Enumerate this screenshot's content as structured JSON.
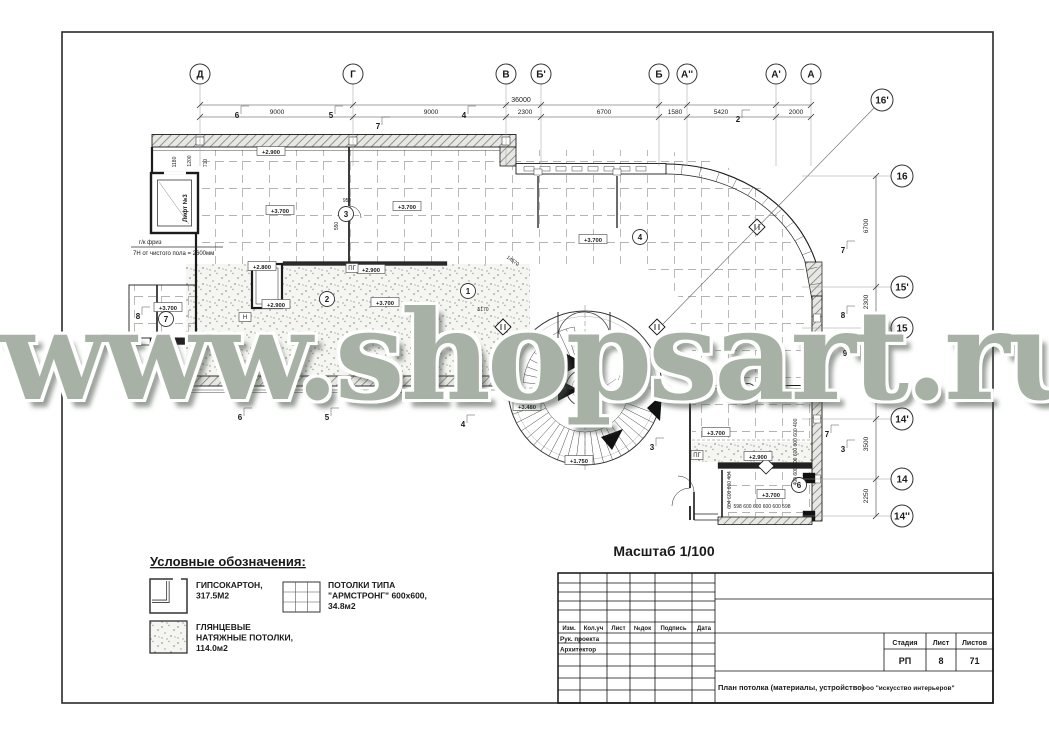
{
  "watermark": "www.shopsart.ru",
  "scale_label": "Масштаб 1/100",
  "legend": {
    "title": "Условные обозначения:",
    "items": [
      {
        "symbol": "drywall-symbol",
        "lines": [
          "ГИПСОКАРТОН,",
          "317.5М2"
        ]
      },
      {
        "symbol": "armstrong-symbol",
        "lines": [
          "ПОТОЛКИ ТИПА",
          "\"АРМСТРОНГ\" 600x600,",
          "34.8м2"
        ]
      },
      {
        "symbol": "gloss-symbol",
        "lines": [
          "ГЛЯНЦЕВЫЕ",
          "НАТЯЖНЫЕ ПОТОЛКИ,",
          "114.0м2"
        ]
      }
    ]
  },
  "axes_top": [
    {
      "label": "Д",
      "x": 200
    },
    {
      "label": "Г",
      "x": 353
    },
    {
      "label": "В",
      "x": 506
    },
    {
      "label": "Б'",
      "x": 541
    },
    {
      "label": "Б",
      "x": 659
    },
    {
      "label": "А''",
      "x": 687
    },
    {
      "label": "А'",
      "x": 776
    },
    {
      "label": "А",
      "x": 811
    }
  ],
  "axes_right": [
    {
      "label": "16'",
      "x": 882,
      "y": 100,
      "line": false
    },
    {
      "label": "16",
      "x": 902,
      "y": 176,
      "line": true
    },
    {
      "label": "15'",
      "x": 902,
      "y": 287,
      "line": true
    },
    {
      "label": "15",
      "x": 902,
      "y": 328,
      "line": true
    },
    {
      "label": "14'",
      "x": 902,
      "y": 419,
      "line": true
    },
    {
      "label": "14",
      "x": 902,
      "y": 479,
      "line": true
    },
    {
      "label": "14''",
      "x": 902,
      "y": 516,
      "line": true
    }
  ],
  "dims_top": {
    "total": {
      "text": "36000",
      "x": 521,
      "y": 102
    },
    "segments": [
      {
        "text": "9000",
        "x": 277
      },
      {
        "text": "9000",
        "x": 431
      },
      {
        "text": "2300",
        "x": 525
      },
      {
        "text": "6700",
        "x": 604
      },
      {
        "text": "1580",
        "x": 675
      },
      {
        "text": "5420",
        "x": 721
      },
      {
        "text": "2000",
        "x": 796
      }
    ]
  },
  "dims_right": [
    {
      "text": "6700",
      "y": 226
    },
    {
      "text": "2300",
      "y": 302
    },
    {
      "text": "2050",
      "y": 347
    },
    {
      "text": "3500",
      "y": 444
    },
    {
      "text": "2250",
      "y": 496
    }
  ],
  "levels": [
    {
      "text": "+2.900",
      "x": 271,
      "y": 152
    },
    {
      "text": "+3.700",
      "x": 280,
      "y": 211
    },
    {
      "text": "+3.700",
      "x": 407,
      "y": 207
    },
    {
      "text": "+3.700",
      "x": 593,
      "y": 240
    },
    {
      "text": "+2.800",
      "x": 262,
      "y": 267
    },
    {
      "text": "+2.900",
      "x": 371,
      "y": 270
    },
    {
      "text": "+2.900",
      "x": 276,
      "y": 305
    },
    {
      "text": "+3.700",
      "x": 385,
      "y": 303
    },
    {
      "text": "+3.700",
      "x": 168,
      "y": 308
    },
    {
      "text": "+3.480",
      "x": 527,
      "y": 407
    },
    {
      "text": "+1.750",
      "x": 579,
      "y": 461
    },
    {
      "text": "+3.700",
      "x": 716,
      "y": 433
    },
    {
      "text": "+2.900",
      "x": 758,
      "y": 457
    },
    {
      "text": "+3.700",
      "x": 771,
      "y": 495
    }
  ],
  "rooms": [
    {
      "n": "1",
      "x": 468,
      "y": 291
    },
    {
      "n": "2",
      "x": 327,
      "y": 299
    },
    {
      "n": "3",
      "x": 346,
      "y": 214
    },
    {
      "n": "4",
      "x": 640,
      "y": 237
    },
    {
      "n": "5",
      "x": 748,
      "y": 391
    },
    {
      "n": "6",
      "x": 799,
      "y": 485
    },
    {
      "n": "7",
      "x": 166,
      "y": 319
    }
  ],
  "flags": [
    {
      "n": "7",
      "x": 378,
      "y": 129
    },
    {
      "n": "6",
      "x": 237,
      "y": 118
    },
    {
      "n": "5",
      "x": 331,
      "y": 118
    },
    {
      "n": "4",
      "x": 464,
      "y": 118
    },
    {
      "n": "2",
      "x": 738,
      "y": 122
    },
    {
      "n": "6",
      "x": 240,
      "y": 420
    },
    {
      "n": "5",
      "x": 327,
      "y": 420
    },
    {
      "n": "4",
      "x": 463,
      "y": 427
    },
    {
      "n": "3",
      "x": 652,
      "y": 450
    },
    {
      "n": "7",
      "x": 843,
      "y": 253
    },
    {
      "n": "8",
      "x": 843,
      "y": 318
    },
    {
      "n": "9",
      "x": 845,
      "y": 356
    },
    {
      "n": "7",
      "x": 827,
      "y": 437
    },
    {
      "n": "3",
      "x": 843,
      "y": 452
    },
    {
      "n": "8",
      "x": 138,
      "y": 319
    }
  ],
  "notes": [
    {
      "text": "г/к фриз",
      "x": 139,
      "y": 244
    },
    {
      "text": "7Н от чистого пола = 2600мм",
      "x": 133,
      "y": 255,
      "topline": true
    },
    {
      "text": "Лифт №3",
      "x": 187,
      "y": 222,
      "rotate": -90,
      "bold": true
    },
    {
      "text": "Лифт",
      "x": 618,
      "y": 380
    },
    {
      "text": "ПГ",
      "x": 352,
      "y": 270,
      "box": true
    },
    {
      "text": "ПГ",
      "x": 697,
      "y": 457,
      "box": true
    },
    {
      "text": "Н",
      "x": 245,
      "y": 319,
      "box": true
    }
  ],
  "small_dims": [
    {
      "text": "1180",
      "x": 176,
      "y": 162,
      "rotate": -90
    },
    {
      "text": "1200",
      "x": 191,
      "y": 161,
      "rotate": -90
    },
    {
      "text": "710",
      "x": 207,
      "y": 163,
      "rotate": -90
    },
    {
      "text": "958",
      "x": 347,
      "y": 202
    },
    {
      "text": "550",
      "x": 338,
      "y": 226,
      "rotate": -90
    },
    {
      "text": "5170",
      "x": 483,
      "y": 311
    },
    {
      "text": "14570",
      "x": 512,
      "y": 262,
      "rotate": 35
    },
    {
      "text": "400 600 600 600 600 600 400",
      "x": 797,
      "y": 452,
      "rotate": -90
    },
    {
      "text": "604 600 600 404",
      "x": 731,
      "y": 490,
      "rotate": -90
    },
    {
      "text": "598 600 600 600 600 598",
      "x": 762,
      "y": 508
    }
  ],
  "titleblock": {
    "header_cols": [
      "Изм.",
      "Кол.уч",
      "Лист",
      "№док",
      "Подпись",
      "Дата"
    ],
    "role_rows": [
      "Рук. проекта",
      "Архитектор"
    ],
    "stage_label": "Стадия",
    "sheet_label": "Лист",
    "sheets_label": "Листов",
    "stage_value": "РП",
    "sheet_value": "8",
    "sheets_value": "71",
    "doc_title": "План потолка (материалы, устройство)",
    "company": "ооо \"искусство интерьеров\""
  }
}
